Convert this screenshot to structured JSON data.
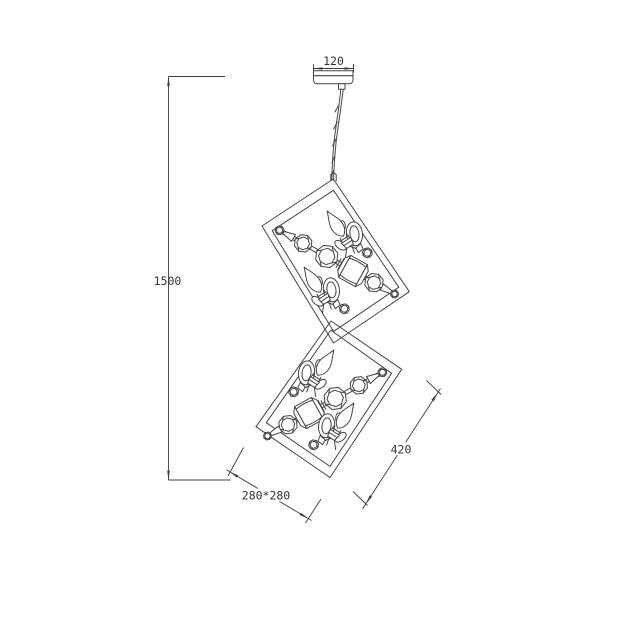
{
  "labels": {
    "canopy_width": "120",
    "drop_height": "1500",
    "frame_diagonal": "420",
    "frame_footprint": "280*280"
  },
  "colors": {
    "line": "#454545",
    "dimension_line": "#3c3c3c",
    "text": "#333333",
    "background": "#ffffff"
  }
}
